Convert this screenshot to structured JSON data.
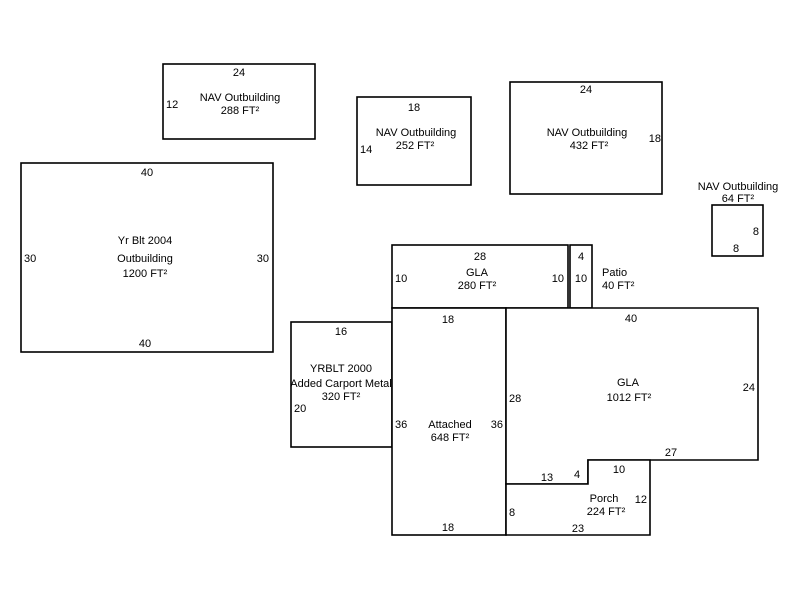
{
  "app": {
    "background": "#ffffff",
    "line_color": "#000000",
    "text_color": "#000000"
  },
  "buildings": {
    "yrblt2004_outbuilding": {
      "line1": "Yr Blt 2004",
      "line2": "Outbuilding",
      "line3": "1200 FT²",
      "dim_top": "40",
      "dim_bottom": "40",
      "dim_left": "30",
      "dim_right": "30"
    },
    "nav_outbuilding_288": {
      "line1": "NAV Outbuilding",
      "line2": "288 FT²",
      "dim_top": "24",
      "dim_left": "12"
    },
    "nav_outbuilding_252": {
      "line1": "NAV Outbuilding",
      "line2": "252 FT²",
      "dim_top": "18",
      "dim_left": "14"
    },
    "nav_outbuilding_432": {
      "line1": "NAV Outbuilding",
      "line2": "432 FT²",
      "dim_top": "24",
      "dim_right": "18"
    },
    "nav_outbuilding_64": {
      "line1": "NAV Outbuilding",
      "line2": "64 FT²",
      "dim_right": "8",
      "dim_bottom": "8"
    },
    "gla_280": {
      "line1": "GLA",
      "line2": "280 FT²",
      "dim_top": "28",
      "dim_left": "10",
      "dim_right": "10"
    },
    "patio_40": {
      "line1": "Patio",
      "line2": "40 FT²",
      "dim_top": "4",
      "dim_side": "10"
    },
    "yrblt2000_carport": {
      "line1": "YRBLT 2000",
      "line2": "Added Carport Metal",
      "line3": "320 FT²",
      "dim_top": "16",
      "dim_left": "20"
    },
    "attached_648": {
      "line1": "Attached",
      "line2": "648 FT²",
      "dim_top": "18",
      "dim_left": "36",
      "dim_right": "36",
      "dim_bottom": "18"
    },
    "gla_1012": {
      "line1": "GLA",
      "line2": "1012 FT²",
      "dim_top": "40",
      "dim_left": "28",
      "dim_right": "24",
      "dim_bottom": "27",
      "dim_step_horizontal": "13",
      "dim_step_vertical": "4"
    },
    "porch_224": {
      "line1": "Porch",
      "line2": "224 FT²",
      "dim_top": "10",
      "dim_left": "8",
      "dim_right": "12",
      "dim_bottom": "23"
    }
  }
}
